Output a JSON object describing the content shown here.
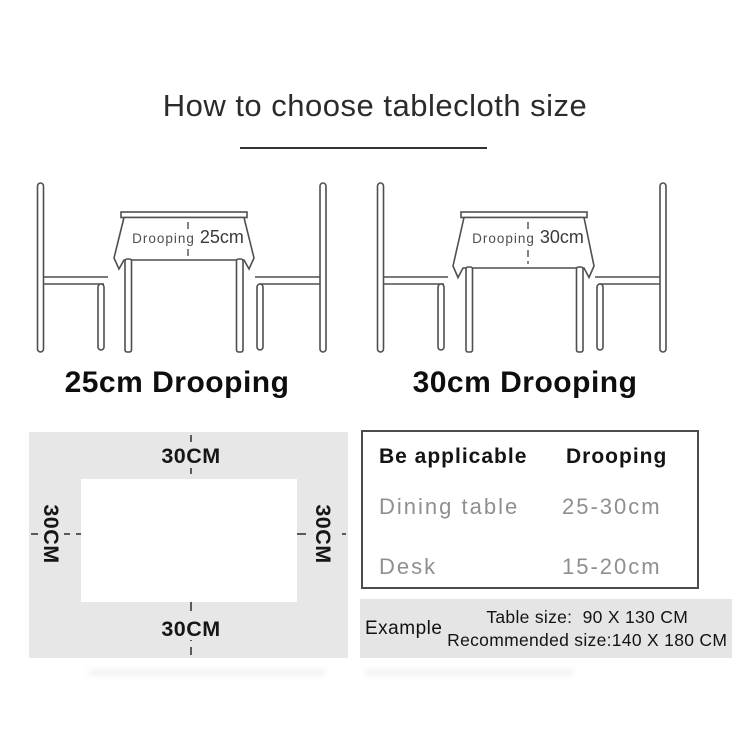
{
  "title": "How to choose tablecloth size",
  "diagram_left": {
    "drooping_word": "Drooping",
    "value": "25cm",
    "caption": "25cm Drooping"
  },
  "diagram_right": {
    "drooping_word": "Drooping",
    "value": "30cm",
    "caption": "30cm Drooping"
  },
  "margin_diagram": {
    "top": "30CM",
    "bottom": "30CM",
    "left": "30CM",
    "right": "30CM"
  },
  "spec_table": {
    "headers": [
      "Be applicable",
      "Drooping"
    ],
    "rows": [
      [
        "Dining table",
        "25-30cm"
      ],
      [
        "Desk",
        "15-20cm"
      ]
    ]
  },
  "example": {
    "label": "Example",
    "line1": "Table size:  90 X 130 CM",
    "line2": "Recommended size:140 X 180 CM"
  },
  "colors": {
    "line": "#4f4f4f",
    "panel_bg": "#e7e7e7",
    "muted_text": "#8f8f8f",
    "text": "#1a1a1a"
  }
}
